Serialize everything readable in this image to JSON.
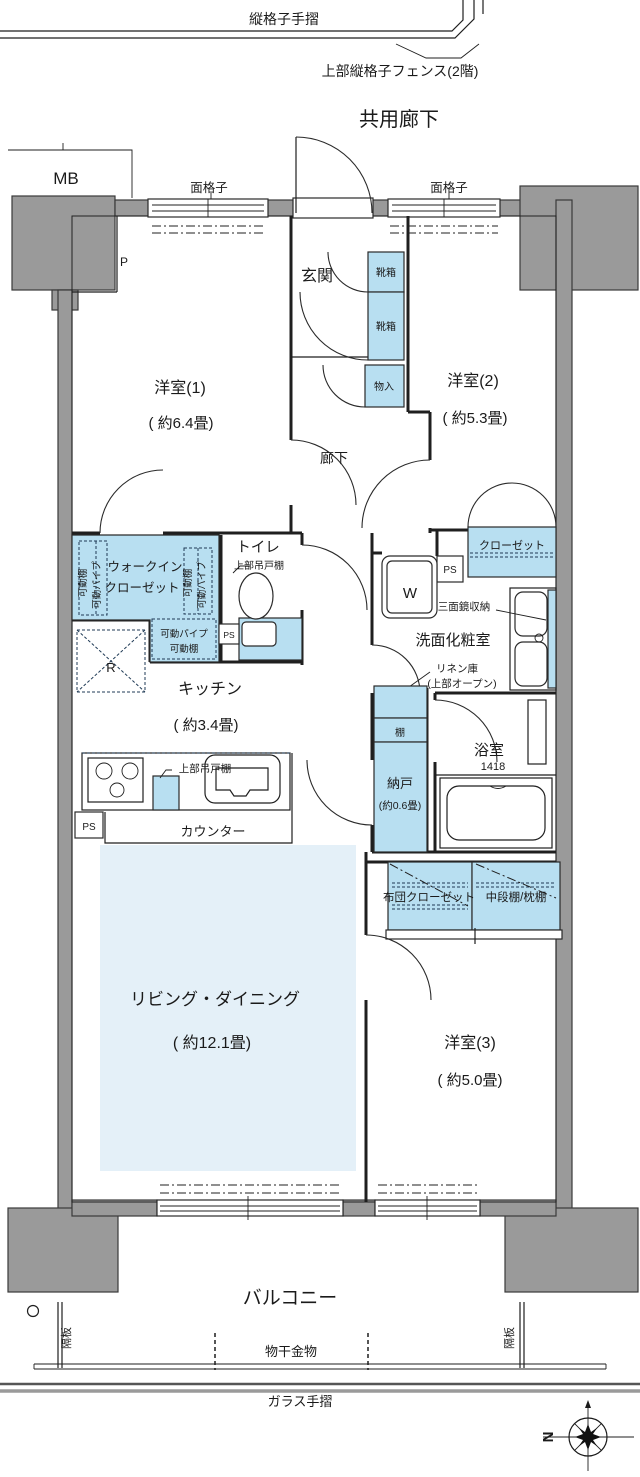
{
  "colors": {
    "structure_gray": "#9a9a9a",
    "fixture_blue": "#b8dff1",
    "living_blue": "#e4f0f8",
    "line": "#1f1f1f"
  },
  "exterior": {
    "vertical_rail": "縦格子手摺",
    "upper_fence": "上部縦格子フェンス(2階)",
    "common_corridor": "共用廊下",
    "mb": "MB",
    "grille_left": "面格子",
    "grille_right": "面格子",
    "p": "P"
  },
  "entry": {
    "genkan": "玄関",
    "shoebox_upper": "靴箱",
    "shoebox_lower": "靴箱",
    "storage": "物入",
    "hallway": "廊下"
  },
  "rooms": {
    "room1_label": "洋室(1)",
    "room1_size": "( 約6.4畳)",
    "room2_label": "洋室(2)",
    "room2_size": "( 約5.3畳)",
    "room3_label": "洋室(3)",
    "room3_size": "( 約5.0畳)",
    "living_label": "リビング・ダイニング",
    "living_size": "( 約12.1畳)",
    "kitchen_label": "キッチン",
    "kitchen_size": "( 約3.4畳)"
  },
  "storage": {
    "wic_line1": "ウォークイン",
    "wic_line2": "クローゼット",
    "shelf_left": "可動棚",
    "pipe_left": "可動パイプ",
    "shelf_right": "可動棚",
    "pipe_right": "可動パイプ",
    "pipe_bottom": "可動パイプ",
    "shelf_bottom": "可動棚",
    "closet2": "クローゼット",
    "futon_left": "布団クローゼット",
    "futon_right": "中段棚/枕棚",
    "nando_shelf": "棚",
    "nando_label": "納戸",
    "nando_size": "(約0.6畳)",
    "linen_line1": "リネン庫",
    "linen_line2": "(上部オープン)"
  },
  "sanitary": {
    "toilet_label": "トイレ",
    "toilet_cabinet": "上部吊戸棚",
    "washroom": "洗面化粧室",
    "mirror_note": "三面鏡収納",
    "washer": "W",
    "bath_label": "浴室",
    "bath_size": "1418"
  },
  "kitchen_fixtures": {
    "upper_cabinet": "上部吊戸棚",
    "counter": "カウンター",
    "fridge": "R"
  },
  "service": {
    "ps_toilet": "PS",
    "ps_mid": "PS",
    "ps_kitchen": "PS"
  },
  "balcony": {
    "label": "バルコニー",
    "partition_left": "隔板",
    "partition_right": "隔板",
    "laundry_fitting": "物干金物",
    "glass_rail": "ガラス手摺"
  },
  "compass": {
    "north": "N"
  }
}
